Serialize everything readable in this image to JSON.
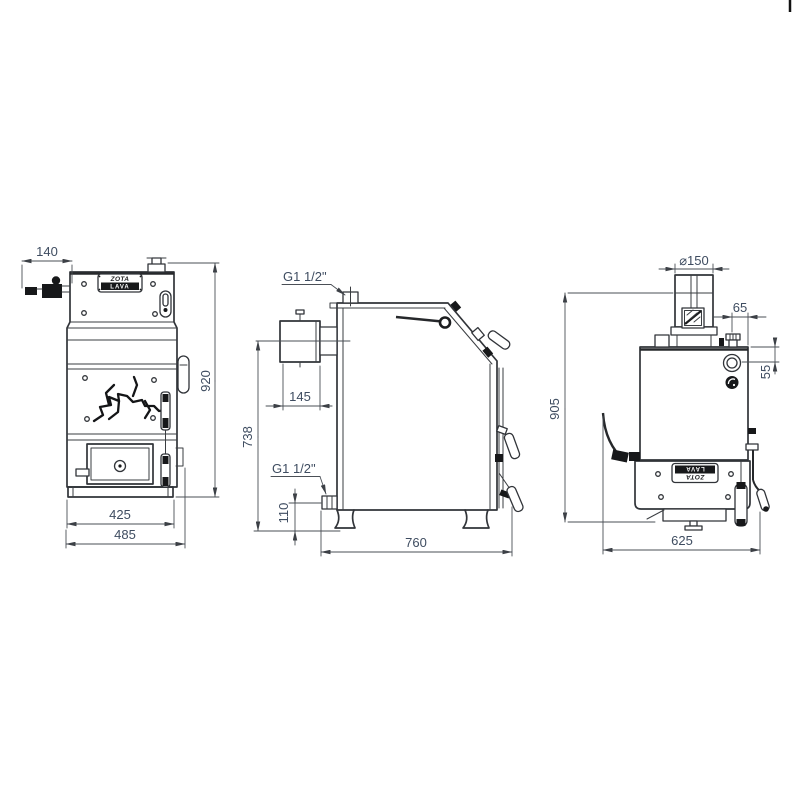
{
  "drawing": {
    "brand": {
      "name": "ZOTA",
      "model": "LAVA"
    },
    "front_view": {
      "dim_valve_offset": "140",
      "dim_height": "920",
      "dim_width_body": "425",
      "dim_width_overall": "485"
    },
    "side_view": {
      "label_top_fitting": "G1 1/2\"",
      "dim_flue_depth": "145",
      "dim_flue_axis_height": "738",
      "label_bottom_fitting": "G1 1/2\"",
      "dim_return_height": "110",
      "dim_depth": "760"
    },
    "rear_view": {
      "dim_flue_diameter": "⌀150",
      "dim_fitting_offset": "65",
      "dim_fitting_drop": "55",
      "dim_height": "905",
      "dim_width": "625"
    }
  }
}
